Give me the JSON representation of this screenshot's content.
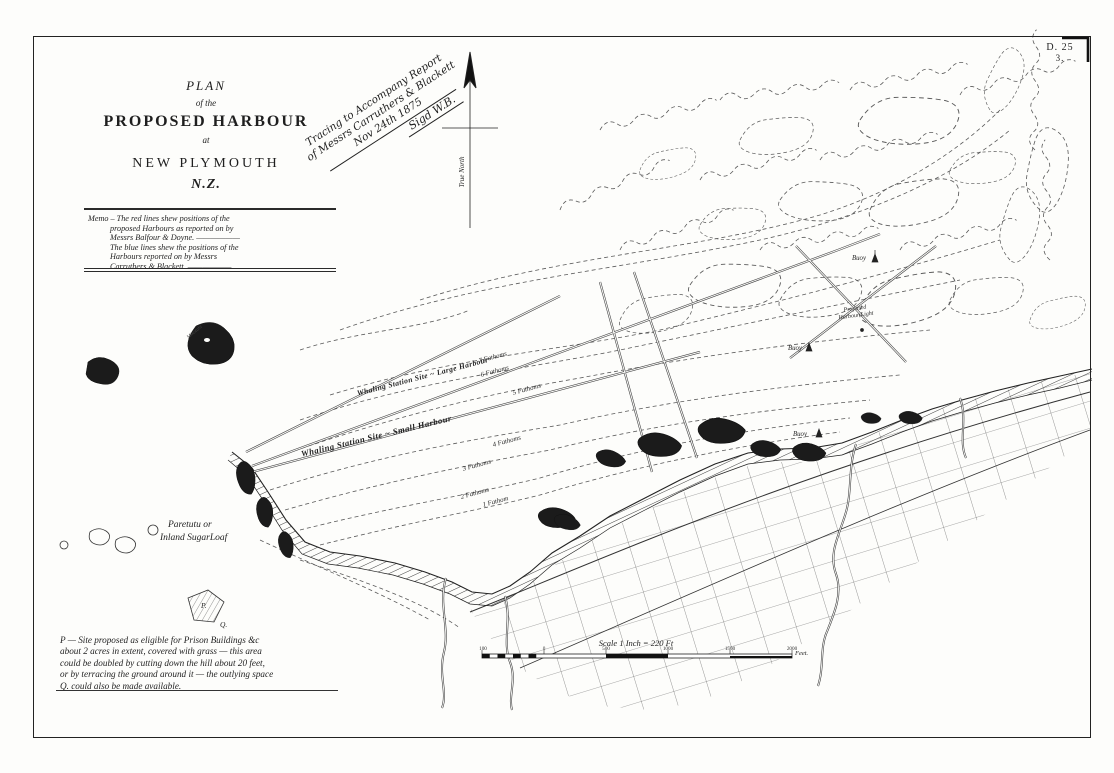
{
  "colors": {
    "paper": "#fdfdfb",
    "ink": "#1f1f1f",
    "contour": "#5a5a5a"
  },
  "sheet_ref": {
    "code": "D. 25",
    "number": "3."
  },
  "title_block": {
    "plan": "PLAN",
    "of_the": "of the",
    "main": "PROPOSED HARBOUR",
    "at": "at",
    "place": "NEW PLYMOUTH",
    "country": "N.Z."
  },
  "memo": {
    "lines": [
      "Memo – The red lines shew positions of the",
      "proposed Harbours as reported on by",
      "Messrs Balfour & Doyne. ——————",
      "The blue lines shew the positions of the",
      "Harbours reported on by Messrs",
      "Carruthers & Blackett. ——————"
    ]
  },
  "annotation": {
    "lines": [
      "Tracing to Accompany Report",
      "of Messrs Carruthers & Blackett",
      "Nov 24th 1875"
    ],
    "signature": "Sigd W.B."
  },
  "north_arrow": {
    "label": "True North"
  },
  "map_labels": {
    "whaling_large": "Whaling Station Site ~ Large Harbour",
    "whaling_small": "Whaling Station Site ~ Small Harbour",
    "soundings": [
      "7 Fathoms",
      "6 Fathoms",
      "5 Fathoms",
      "4 Fathoms",
      "3 Fathoms",
      "2 Fathoms",
      "1 Fathom"
    ],
    "paretutu_line1": "Paretutu or",
    "paretutu_line2": "Inland SugarLoaf",
    "harbour_light_line1": "Proposed",
    "harbour_light_line2": "Harbour Light",
    "buoy_north": "Buoy",
    "buoy_mid": "Buoy",
    "buoy_south": "Buoy",
    "islet": "Mikotahi",
    "site_p": "P.",
    "site_q": "Q."
  },
  "note": {
    "lines": [
      "P — Site proposed as eligible for Prison Buildings &c",
      "about 2 acres in extent, covered with grass — this area",
      "could be doubled by cutting down the hill about 20 feet,",
      "or by terracing the ground around it — the outlying space",
      "Q. could also be made available."
    ]
  },
  "scale_bar": {
    "title": "Scale 1 Inch = 220 Ft",
    "ticks": [
      "100",
      "0",
      "500",
      "1000",
      "1500",
      "2000"
    ],
    "unit": "Feet."
  }
}
